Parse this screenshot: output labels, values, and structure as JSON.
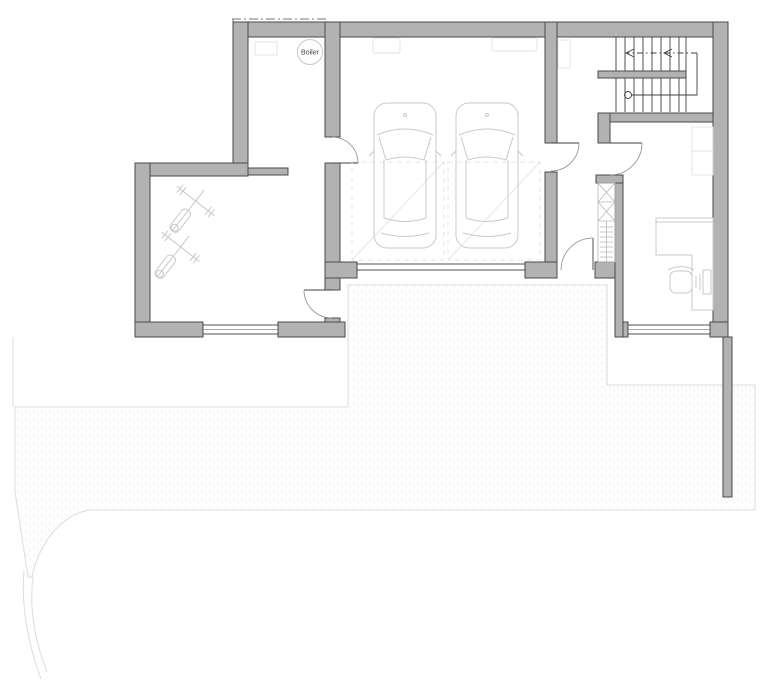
{
  "plan": {
    "labels": {
      "boiler": "Boiler"
    },
    "colors": {
      "wall_fill": "#b2b2b2",
      "wall_edge": "#4a4a4a",
      "line_dark": "#3f3f3f",
      "line_mid": "#8a8a8a",
      "furniture": "#c9c9c9",
      "furniture_light": "#e2e2e2",
      "paving_fill": "#f8f8f6",
      "paving_mark": "#e9e9e4",
      "paving_edge": "#dcdcd8",
      "background": "#ffffff",
      "text_color": "#444444"
    },
    "symbols": [
      "boiler-circle",
      "car-top-view",
      "car-top-view",
      "weight-bench",
      "weight-bench",
      "staircase",
      "stair-direction-arrow",
      "wardrobe-x-hatch",
      "desk",
      "office-chair",
      "computer",
      "garage-door",
      "window",
      "door-swing",
      "paved-driveway",
      "overhang-dashed-line"
    ]
  }
}
